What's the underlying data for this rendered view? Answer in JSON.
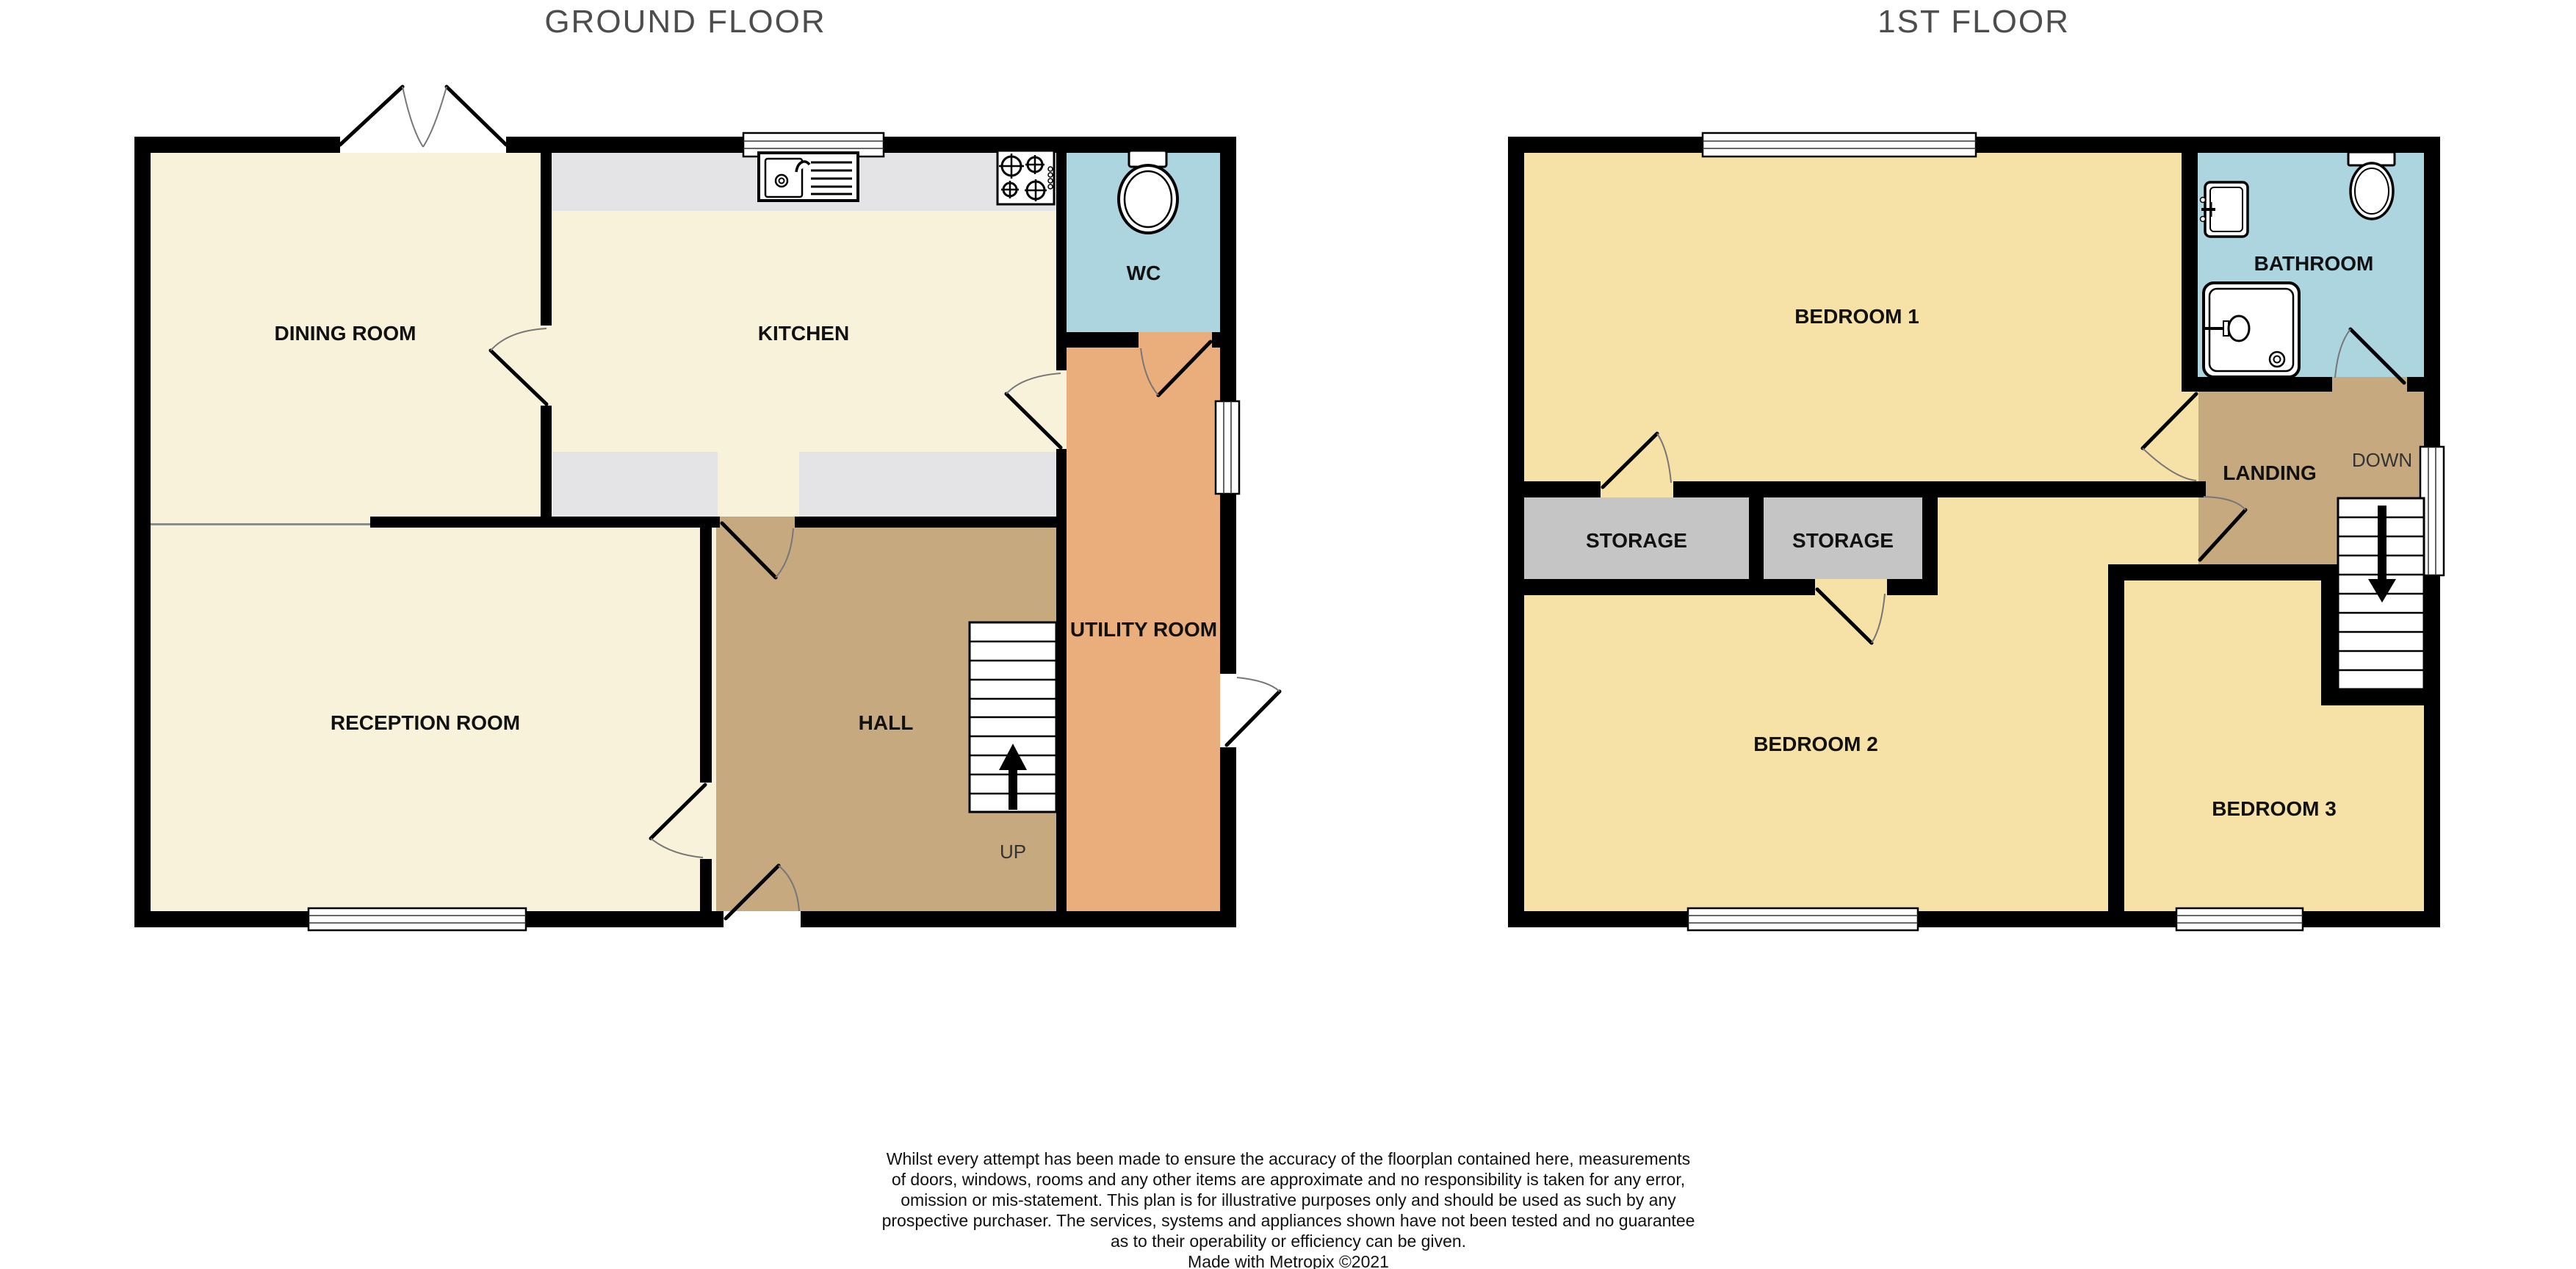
{
  "colors": {
    "floor_cream": "#F8F2DB",
    "floor_yellow": "#F6E2A7",
    "floor_tan": "#C7A980",
    "floor_orange": "#EAAE7D",
    "floor_blue": "#ACD5E0",
    "counter_gray": "#E4E4E6",
    "storage_gray": "#C5C5C5",
    "wall_black": "#000000",
    "title_gray": "#4D4D4D",
    "label_black": "#111111"
  },
  "ground_floor": {
    "title": "GROUND FLOOR",
    "rooms": {
      "dining_room": {
        "label": "DINING ROOM"
      },
      "kitchen": {
        "label": "KITCHEN"
      },
      "wc": {
        "label": "WC"
      },
      "reception_room": {
        "label": "RECEPTION ROOM"
      },
      "hall": {
        "label": "HALL"
      },
      "utility_room": {
        "label": "UTILITY ROOM"
      }
    },
    "stairs_label": "UP"
  },
  "first_floor": {
    "title": "1ST FLOOR",
    "rooms": {
      "bedroom1": {
        "label": "BEDROOM 1"
      },
      "bathroom": {
        "label": "BATHROOM"
      },
      "landing": {
        "label": "LANDING"
      },
      "storage_left": {
        "label": "STORAGE"
      },
      "storage_right": {
        "label": "STORAGE"
      },
      "bedroom2": {
        "label": "BEDROOM 2"
      },
      "bedroom3": {
        "label": "BEDROOM 3"
      }
    },
    "stairs_label": "DOWN"
  },
  "disclaimer": {
    "lines": [
      "Whilst every attempt has been made to ensure the accuracy of the floorplan contained here, measurements",
      "of doors, windows, rooms and any other items are approximate and no responsibility is taken for any error,",
      "omission or mis-statement. This plan is for illustrative purposes only and should be used as such by any",
      "prospective purchaser. The services, systems and appliances shown have not been tested and no guarantee",
      "as to their operability or efficiency can be given.",
      "Made with Metropix ©2021"
    ]
  }
}
